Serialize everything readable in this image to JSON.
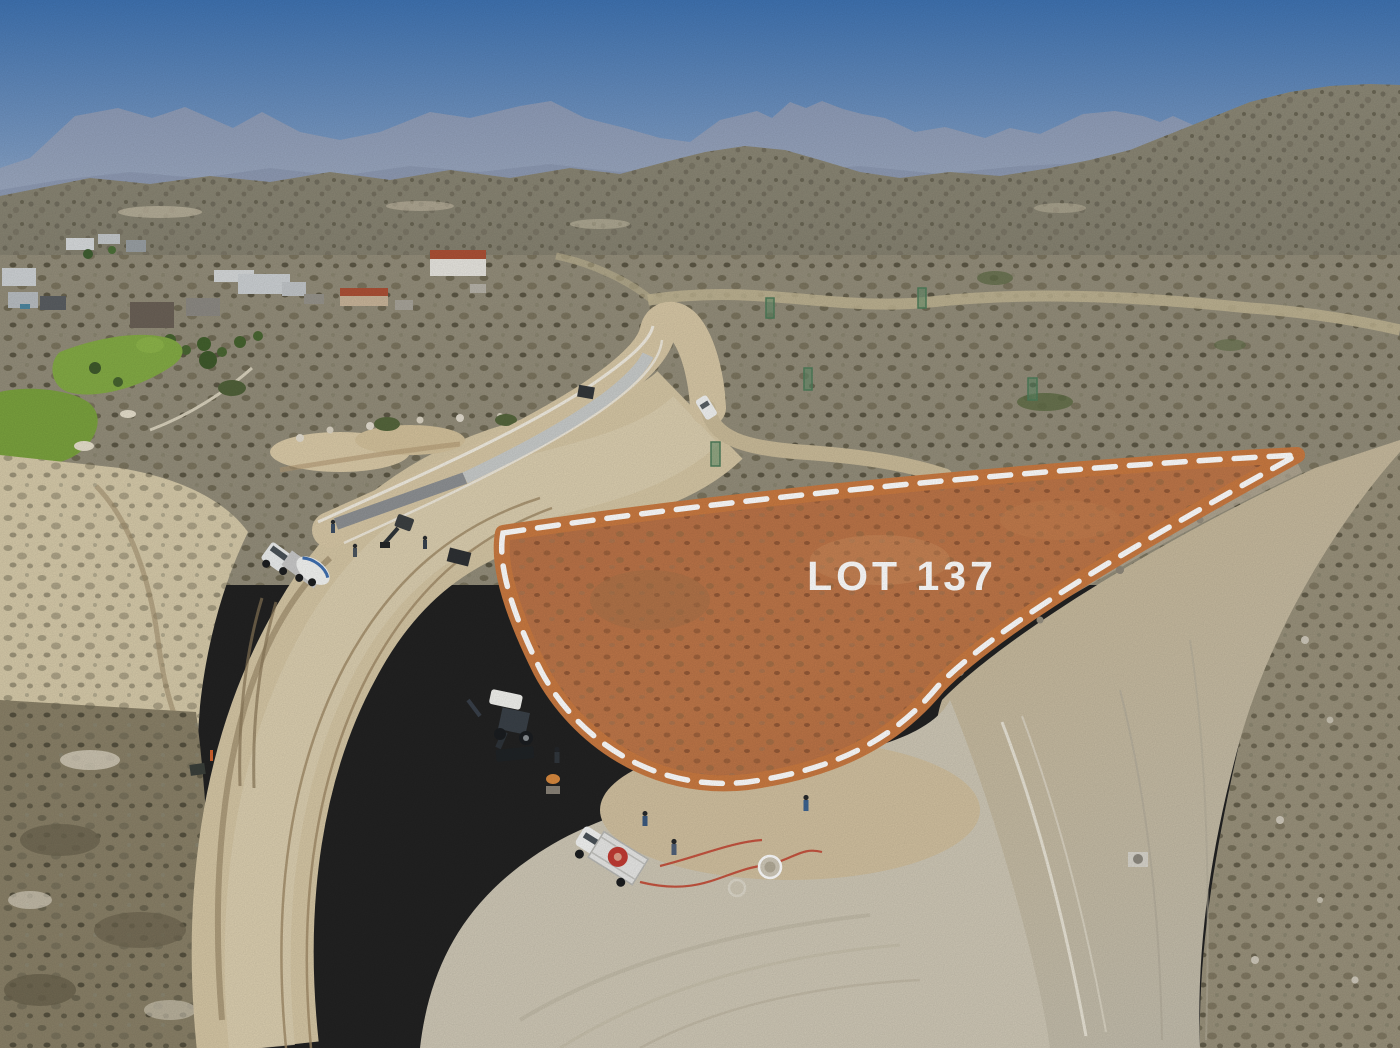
{
  "image": {
    "kind": "aerial-drone-photo",
    "subject": "Desert hillside real-estate development under construction with one lot highlighted for sale",
    "width_px": 1400,
    "height_px": 1048
  },
  "lot": {
    "label": "LOT 137",
    "label_color": "#ffffff",
    "outline_color": "#ca7a41",
    "dash_color": "#ffffff",
    "fill_tint": "rgba(198,108,52,0.28)"
  },
  "scene": {
    "palette": {
      "sky_top": "#3f73b2",
      "sky_horizon": "#b7c6d7",
      "mountains_far": "#8e9cb8",
      "mountains_haze": "#a5b2c6",
      "scrub_hills": "#86826f",
      "scrub_plain": "#948e7b",
      "desert_floor": "#9a927c",
      "sand_road": "#d6c7a5",
      "pale_pad": "#cfc8b6",
      "fresh_concrete": "#8e9194",
      "cured_concrete": "#c9cccb",
      "golf_green": "#7ba33e",
      "lot_dirt": "#b97a50",
      "tile_roof": "#ad5136",
      "spool_red": "#c23b33"
    },
    "elements": [
      "mountain-range",
      "scrub-hills",
      "hillside-homes",
      "golf-course",
      "switchback-road",
      "fresh-concrete-strip",
      "graded-road",
      "dirt-trail",
      "cement-mixer-truck",
      "mini-excavator",
      "backhoe-loader",
      "flatbed-utility-truck",
      "cable-spool",
      "pickup-truck",
      "construction-workers",
      "manhole",
      "water-hose",
      "rebar-towers",
      "highlighted-lot"
    ]
  }
}
